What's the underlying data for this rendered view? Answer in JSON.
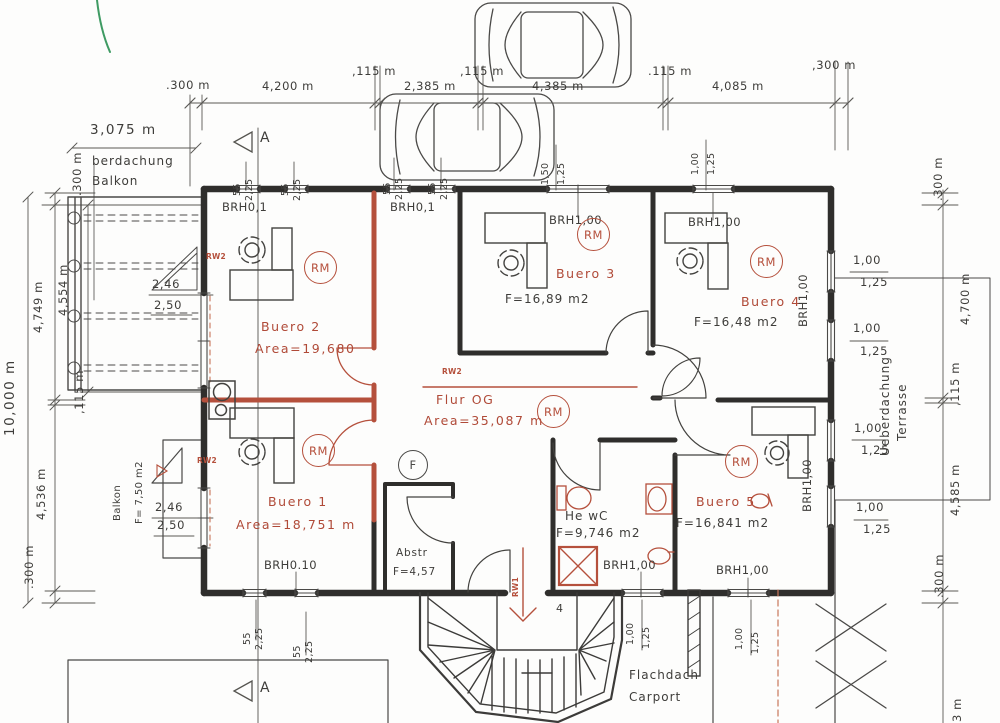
{
  "palette": {
    "wall": "#2f2e2c",
    "line": "#4a4947",
    "thin": "#5a5955",
    "red": "#b5503c",
    "orange_dash": "#c8765a",
    "green": "#3f9b63",
    "paper": "#fdfdfc"
  },
  "markers": [
    {
      "name": "rm-marker-buero-2",
      "label": "RM",
      "x": 304,
      "y": 251,
      "size": 33,
      "color": "red"
    },
    {
      "name": "rm-marker-buero-3",
      "label": "RM",
      "x": 577,
      "y": 218,
      "size": 33,
      "color": "red"
    },
    {
      "name": "rm-marker-buero-4",
      "label": "RM",
      "x": 750,
      "y": 245,
      "size": 33,
      "color": "red"
    },
    {
      "name": "rm-marker-flur",
      "label": "RM",
      "x": 537,
      "y": 395,
      "size": 33,
      "color": "red"
    },
    {
      "name": "rm-marker-buero-1",
      "label": "RM",
      "x": 302,
      "y": 434,
      "size": 33,
      "color": "red"
    },
    {
      "name": "rm-marker-buero-5",
      "label": "RM",
      "x": 725,
      "y": 445,
      "size": 33,
      "color": "red"
    },
    {
      "name": "f-marker",
      "label": "F",
      "x": 398,
      "y": 450,
      "size": 30,
      "color": "black"
    }
  ],
  "labels": [
    {
      "n": "dim-top-300-left",
      "t": ".300 m",
      "x": 166,
      "y": 80,
      "c": "d"
    },
    {
      "n": "dim-top-4200",
      "t": "4,200 m",
      "x": 262,
      "y": 81,
      "c": "d"
    },
    {
      "n": "dim-top-115-1",
      "t": ",115 m",
      "x": 352,
      "y": 66,
      "c": "d"
    },
    {
      "n": "dim-top-2385",
      "t": "2,385 m",
      "x": 404,
      "y": 81,
      "c": "d"
    },
    {
      "n": "dim-top-115-2",
      "t": ",115 m",
      "x": 460,
      "y": 66,
      "c": "d"
    },
    {
      "n": "dim-top-4385",
      "t": "4,385 m",
      "x": 532,
      "y": 81,
      "c": "d"
    },
    {
      "n": "dim-top-115-3",
      "t": ".115 m",
      "x": 648,
      "y": 66,
      "c": "d"
    },
    {
      "n": "dim-top-4085",
      "t": "4,085 m",
      "x": 712,
      "y": 81,
      "c": "d"
    },
    {
      "n": "dim-top-300-right",
      "t": ",300 m",
      "x": 812,
      "y": 60,
      "c": "d"
    },
    {
      "n": "dim-balcony-3075",
      "t": "3,075 m",
      "x": 90,
      "y": 124,
      "c": "dl"
    },
    {
      "n": "dim-left-300-top",
      "t": ".300 m",
      "x": 72,
      "y": 196,
      "r": 1,
      "c": "d"
    },
    {
      "n": "dim-left-4749",
      "t": "4,749 m",
      "x": 33,
      "y": 333,
      "r": 1,
      "c": "d"
    },
    {
      "n": "dim-left-4554",
      "t": "4,554 m",
      "x": 58,
      "y": 316,
      "r": 1,
      "c": "d"
    },
    {
      "n": "dim-left-10000",
      "t": "10,000 m",
      "x": 4,
      "y": 436,
      "r": 1,
      "c": "dl"
    },
    {
      "n": "dim-left-115",
      "t": ",115 m",
      "x": 74,
      "y": 414,
      "r": 1,
      "c": "d"
    },
    {
      "n": "dim-left-4536",
      "t": "4,536 m",
      "x": 36,
      "y": 520,
      "r": 1,
      "c": "d"
    },
    {
      "n": "dim-left-300-bottom",
      "t": ".300 m",
      "x": 24,
      "y": 589,
      "r": 1,
      "c": "d"
    },
    {
      "n": "dim-right-300-top",
      "t": ".300 m",
      "x": 933,
      "y": 201,
      "r": 1,
      "c": "d"
    },
    {
      "n": "dim-right-4700",
      "t": "4,700 m",
      "x": 960,
      "y": 325,
      "r": 1,
      "c": "d"
    },
    {
      "n": "dim-right-115",
      "t": ",115 m",
      "x": 950,
      "y": 406,
      "r": 1,
      "c": "d"
    },
    {
      "n": "dim-right-4585",
      "t": "4,585 m",
      "x": 950,
      "y": 516,
      "r": 1,
      "c": "d"
    },
    {
      "n": "dim-right-300-bottom",
      "t": ".300 m",
      "x": 934,
      "y": 598,
      "r": 1,
      "c": "d"
    },
    {
      "n": "dim-right-3m",
      "t": "3 m",
      "x": 952,
      "y": 722,
      "r": 1,
      "c": "d"
    },
    {
      "n": "win-n1-55",
      "t": "55",
      "x": 233,
      "y": 196,
      "r": 1,
      "c": "ds"
    },
    {
      "n": "win-n1-225",
      "t": "2,25",
      "x": 245,
      "y": 201,
      "r": 1,
      "c": "ds"
    },
    {
      "n": "win-n2-55",
      "t": "55",
      "x": 281,
      "y": 196,
      "r": 1,
      "c": "ds"
    },
    {
      "n": "win-n2-225",
      "t": "2,25",
      "x": 293,
      "y": 201,
      "r": 1,
      "c": "ds"
    },
    {
      "n": "win-n3-55",
      "t": "55",
      "x": 383,
      "y": 195,
      "r": 1,
      "c": "ds"
    },
    {
      "n": "win-n3-225",
      "t": "2,25",
      "x": 395,
      "y": 200,
      "r": 1,
      "c": "ds"
    },
    {
      "n": "win-n4-55",
      "t": "55",
      "x": 428,
      "y": 195,
      "r": 1,
      "c": "ds"
    },
    {
      "n": "win-n4-225",
      "t": "2,25",
      "x": 440,
      "y": 200,
      "r": 1,
      "c": "ds"
    },
    {
      "n": "win-n5-150",
      "t": "1,50",
      "x": 541,
      "y": 185,
      "r": 1,
      "c": "ds"
    },
    {
      "n": "win-n5-125",
      "t": "1,25",
      "x": 557,
      "y": 185,
      "r": 1,
      "c": "ds"
    },
    {
      "n": "win-n6-100",
      "t": "1,00",
      "x": 691,
      "y": 175,
      "r": 1,
      "c": "ds"
    },
    {
      "n": "win-n6-125",
      "t": "1,25",
      "x": 707,
      "y": 175,
      "r": 1,
      "c": "ds"
    },
    {
      "n": "win-e1-100",
      "t": "1,00",
      "x": 853,
      "y": 255,
      "c": "d"
    },
    {
      "n": "win-e1-125",
      "t": "1,25",
      "x": 860,
      "y": 277,
      "c": "d"
    },
    {
      "n": "win-e2-100",
      "t": "1,00",
      "x": 853,
      "y": 323,
      "c": "d"
    },
    {
      "n": "win-e2-125",
      "t": "1,25",
      "x": 860,
      "y": 346,
      "c": "d"
    },
    {
      "n": "win-e3-100",
      "t": "1,00",
      "x": 854,
      "y": 423,
      "c": "d"
    },
    {
      "n": "win-e3-125",
      "t": "1,25",
      "x": 861,
      "y": 445,
      "c": "d"
    },
    {
      "n": "win-e4-100",
      "t": "1,00",
      "x": 856,
      "y": 502,
      "c": "d"
    },
    {
      "n": "win-e4-125",
      "t": "1,25",
      "x": 863,
      "y": 524,
      "c": "d"
    },
    {
      "n": "win-s1-55",
      "t": "55",
      "x": 243,
      "y": 645,
      "r": 1,
      "c": "ds"
    },
    {
      "n": "win-s1-225",
      "t": "2,25",
      "x": 255,
      "y": 650,
      "r": 1,
      "c": "ds"
    },
    {
      "n": "win-s2-55",
      "t": "55",
      "x": 293,
      "y": 658,
      "r": 1,
      "c": "ds"
    },
    {
      "n": "win-s2-225",
      "t": "2,25",
      "x": 305,
      "y": 663,
      "r": 1,
      "c": "ds"
    },
    {
      "n": "win-s3-100",
      "t": "1,00",
      "x": 626,
      "y": 645,
      "r": 1,
      "c": "ds"
    },
    {
      "n": "win-s3-125",
      "t": "1,25",
      "x": 642,
      "y": 649,
      "r": 1,
      "c": "ds"
    },
    {
      "n": "win-s4-100",
      "t": "1,00",
      "x": 735,
      "y": 650,
      "r": 1,
      "c": "ds"
    },
    {
      "n": "win-s4-125",
      "t": "1,25",
      "x": 751,
      "y": 654,
      "r": 1,
      "c": "ds"
    },
    {
      "n": "brh-nw1",
      "t": "BRH0,1",
      "x": 222,
      "y": 202,
      "c": "br"
    },
    {
      "n": "brh-nw2",
      "t": "BRH0,1",
      "x": 390,
      "y": 202,
      "c": "br"
    },
    {
      "n": "brh-buero3",
      "t": "BRH1,00",
      "x": 549,
      "y": 215,
      "c": "br"
    },
    {
      "n": "brh-buero4",
      "t": "BRH1,00",
      "x": 688,
      "y": 217,
      "c": "br"
    },
    {
      "n": "brh-buero1",
      "t": "BRH0.10",
      "x": 264,
      "y": 560,
      "c": "br"
    },
    {
      "n": "brh-hewc",
      "t": "BRH1,00",
      "x": 603,
      "y": 560,
      "c": "br"
    },
    {
      "n": "brh-buero5",
      "t": "BRH1,00",
      "x": 716,
      "y": 565,
      "c": "br"
    },
    {
      "n": "brh-east-1",
      "t": "BRH1,00",
      "x": 798,
      "y": 327,
      "r": 1,
      "c": "br"
    },
    {
      "n": "brh-east-2",
      "t": "BRH1,00",
      "x": 802,
      "y": 512,
      "r": 1,
      "c": "br"
    },
    {
      "n": "room-label-buero-2",
      "t": "Buero 2",
      "x": 261,
      "y": 321,
      "c": "rr"
    },
    {
      "n": "room-area-buero-2",
      "t": "Area=19,680",
      "x": 255,
      "y": 343,
      "c": "rr"
    },
    {
      "n": "room-label-buero-3",
      "t": "Buero 3",
      "x": 556,
      "y": 268,
      "c": "rr"
    },
    {
      "n": "room-area-buero-3",
      "t": "F=16,89 m2",
      "x": 505,
      "y": 293,
      "c": "rb"
    },
    {
      "n": "room-label-buero-4",
      "t": "Buero 4",
      "x": 741,
      "y": 296,
      "c": "rr"
    },
    {
      "n": "room-area-buero-4",
      "t": "F=16,48 m2",
      "x": 694,
      "y": 316,
      "c": "rb"
    },
    {
      "n": "room-label-flur-og",
      "t": "Flur OG",
      "x": 436,
      "y": 394,
      "c": "rr"
    },
    {
      "n": "room-area-flur-og",
      "t": "Area=35,087 m",
      "x": 424,
      "y": 415,
      "c": "rr"
    },
    {
      "n": "room-label-buero-1",
      "t": "Buero 1",
      "x": 268,
      "y": 496,
      "c": "rr"
    },
    {
      "n": "room-area-buero-1",
      "t": "Area=18,751 m",
      "x": 236,
      "y": 519,
      "c": "rr"
    },
    {
      "n": "room-label-buero-5",
      "t": "Buero 5",
      "x": 696,
      "y": 496,
      "c": "rr"
    },
    {
      "n": "room-area-buero-5",
      "t": "F=16,841 m2",
      "x": 676,
      "y": 517,
      "c": "rb"
    },
    {
      "n": "room-label-he-wc",
      "t": "He wC",
      "x": 565,
      "y": 510,
      "c": "rb"
    },
    {
      "n": "room-area-he-wc",
      "t": "F=9,746 m2",
      "x": 556,
      "y": 527,
      "c": "rb"
    },
    {
      "n": "room-label-abstr",
      "t": "Abstr",
      "x": 396,
      "y": 548,
      "c": "rs"
    },
    {
      "n": "room-area-abstr",
      "t": "F=4,57",
      "x": 393,
      "y": 567,
      "c": "rs"
    },
    {
      "n": "note-berdachung",
      "t": "berdachung",
      "x": 92,
      "y": 155,
      "c": "note"
    },
    {
      "n": "note-balkon-top",
      "t": "Balkon",
      "x": 92,
      "y": 175,
      "c": "note"
    },
    {
      "n": "dim-door-246-top",
      "t": "2,46",
      "x": 152,
      "y": 279,
      "c": "d"
    },
    {
      "n": "dim-door-250-top",
      "t": "2,50",
      "x": 154,
      "y": 300,
      "c": "d"
    },
    {
      "n": "dim-door-246-bottom",
      "t": "2,46",
      "x": 155,
      "y": 502,
      "c": "d"
    },
    {
      "n": "dim-door-250-bottom",
      "t": "2,50",
      "x": 157,
      "y": 520,
      "c": "d"
    },
    {
      "n": "note-balkon-bottom",
      "t": "Balkon",
      "x": 113,
      "y": 521,
      "r": 1,
      "c": "ns"
    },
    {
      "n": "note-balkon-area",
      "t": "F= 7,50 m2",
      "x": 135,
      "y": 524,
      "r": 1,
      "c": "ns"
    },
    {
      "n": "note-ueberdachung",
      "t": "Ueberdachung",
      "x": 879,
      "y": 456,
      "r": 1,
      "c": "note"
    },
    {
      "n": "note-terrasse",
      "t": "Terrasse",
      "x": 896,
      "y": 441,
      "r": 1,
      "c": "note"
    },
    {
      "n": "note-flachdach",
      "t": "Flachdach",
      "x": 629,
      "y": 669,
      "c": "note"
    },
    {
      "n": "note-carport",
      "t": "Carport",
      "x": 629,
      "y": 691,
      "c": "note"
    },
    {
      "n": "section-a-top",
      "t": "A",
      "x": 260,
      "y": 131,
      "c": "sec"
    },
    {
      "n": "section-a-bottom",
      "t": "A",
      "x": 260,
      "y": 681,
      "c": "sec"
    },
    {
      "n": "rw2-label-balcony-top",
      "t": "RW2",
      "x": 206,
      "y": 253,
      "c": "rw"
    },
    {
      "n": "rw2-label-flur",
      "t": "RW2",
      "x": 442,
      "y": 368,
      "c": "rw"
    },
    {
      "n": "rw2-label-balcony-bottom",
      "t": "RW2",
      "x": 197,
      "y": 457,
      "c": "rw"
    },
    {
      "n": "rw1-label-stairs",
      "t": "RW1",
      "x": 512,
      "y": 597,
      "r": 1,
      "c": "rw"
    },
    {
      "n": "stair-step-number",
      "t": "4",
      "x": 556,
      "y": 603,
      "c": "sn"
    }
  ]
}
